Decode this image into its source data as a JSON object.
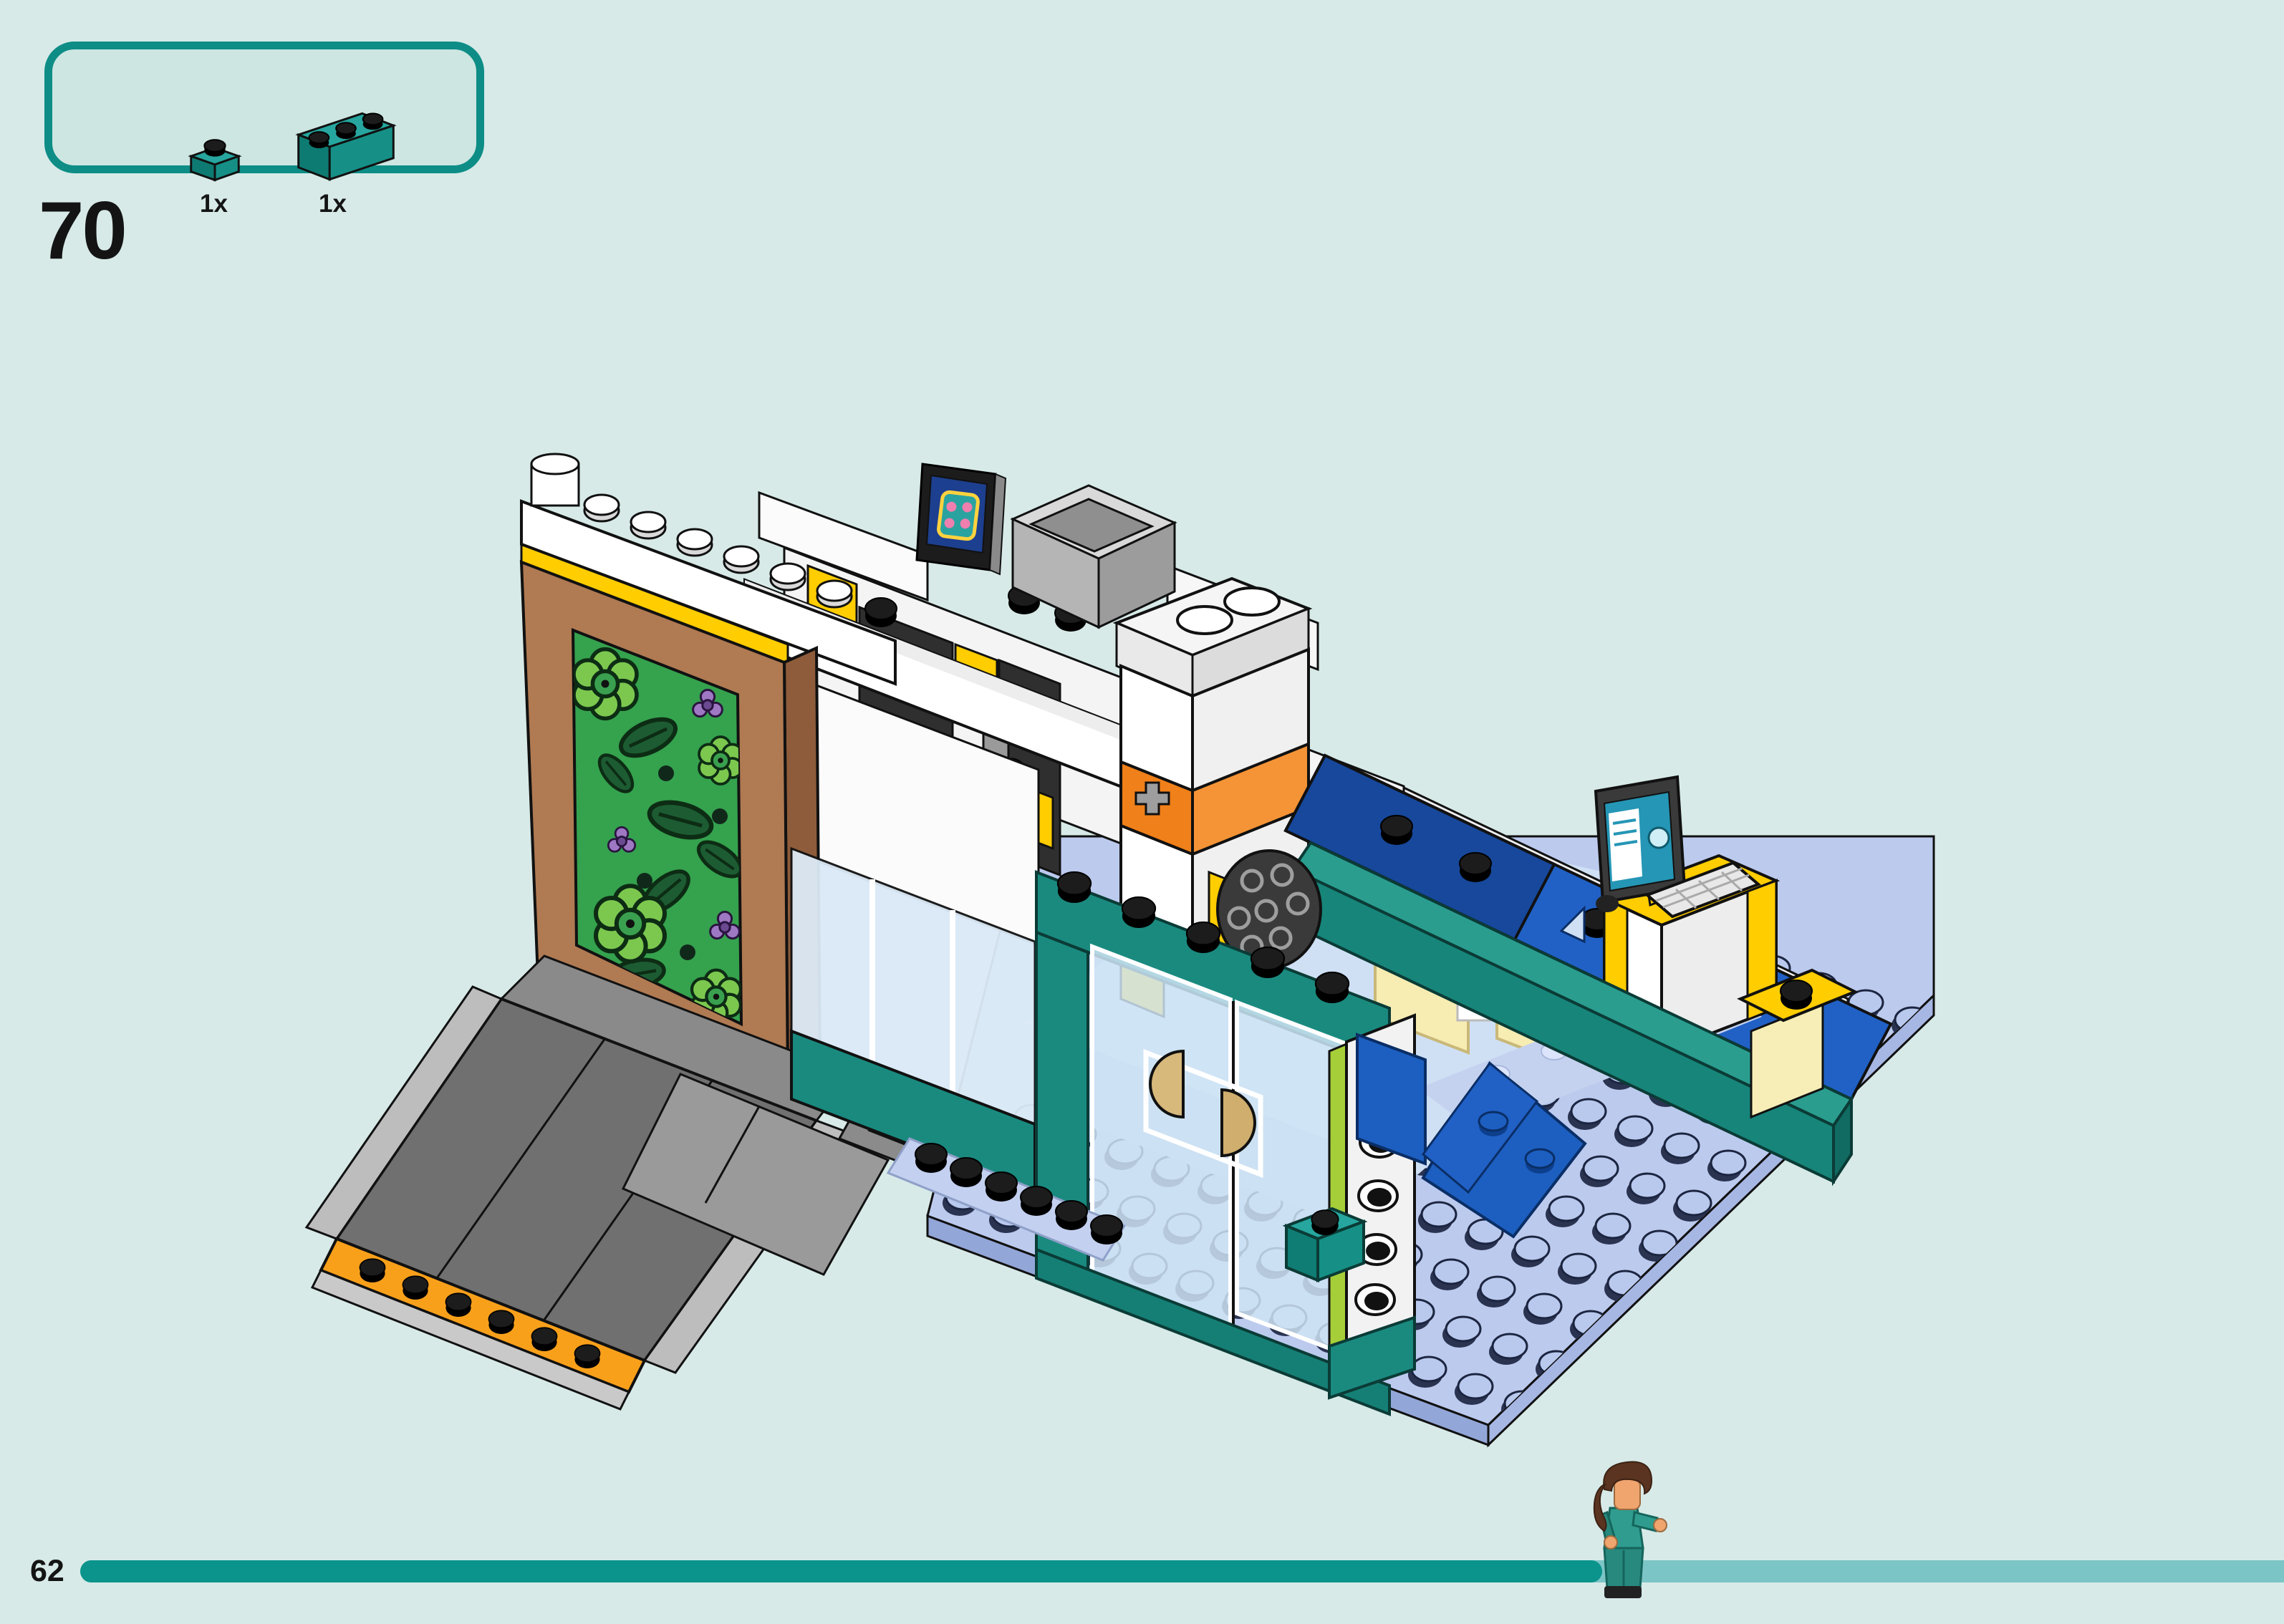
{
  "page": {
    "step_number": "70",
    "page_number": "62",
    "background_color": "#d7eae8",
    "accent_color": "#0d8d86"
  },
  "parts_callout": {
    "parts": [
      {
        "quantity": "1x",
        "part_name": "teal-1x1-plate",
        "color": "#26a69e"
      },
      {
        "quantity": "1x",
        "part_name": "teal-1x3-brick",
        "color": "#26a69e"
      }
    ]
  },
  "progress_bar": {
    "filled_color": "#0a948c",
    "remaining_color": "#7cc5c6",
    "filled_ratio": 0.69
  },
  "illustration": {
    "name": "lego-city-clinic-building-isometric-view",
    "palette": {
      "baseplate": "#bccaee",
      "baseplate_side": "#93a6d8",
      "stud": "#b9c9ee",
      "teal_brick": "#1a8a7f",
      "blue_tile": "#1d5fc0",
      "navy_roof": "#17489c",
      "yellow": "#ffcd00",
      "orange_band": "#f08019",
      "ramp_orange": "#f9a01b",
      "ramp_grey": "#707070",
      "rail_grey": "#bdbdbd",
      "brown_frame": "#b07a52",
      "plant_green": "#35a24e",
      "leaf_green": "#1d5c33",
      "flower_green": "#7cc84f",
      "flower_purple": "#9f78c4",
      "lime": "#a6ce39",
      "glass": "#cfe4f4",
      "white": "#ffffff",
      "dark_window": "#2f2f2f",
      "screen_blue": "#1d3f8f",
      "monitor_screen": "#2596b5",
      "tan_handle": "#d7b97c",
      "minifig_scrubs": "#2f9c8f",
      "minifig_skin": "#f0a46e",
      "minifig_hair": "#5a3420"
    }
  }
}
